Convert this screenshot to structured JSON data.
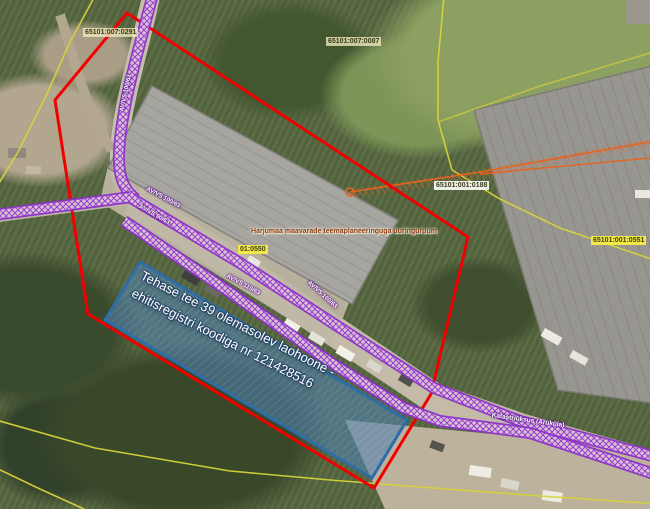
{
  "view": {
    "title": "aerial-planning-map",
    "parcel_labels": [
      {
        "text": "65101:007:0291"
      },
      {
        "text": "65101:007:0087"
      },
      {
        "text": "65101:001:0188"
      },
      {
        "text": "65101:001:0551"
      },
      {
        "text": "01:0550"
      }
    ],
    "survey_area_label": {
      "text": "Harjumaa maavarade teemaplaneeringuga uuringuruum"
    },
    "utility_labels": [
      {
        "text": "AV/VS 100/63"
      },
      {
        "text": "AV/VS 100/63"
      },
      {
        "text": "AV/VS 90/63"
      },
      {
        "text": "AV/VS 110/63"
      },
      {
        "text": "AV/VS 100/63"
      },
      {
        "text": "Katastriüksus (Aruküla)"
      }
    ],
    "highlighted_building_label": {
      "line1": "Tehase tee 39 olemasolev laohoone -",
      "line2": "ehitisregistri koodiga nr 121428516",
      "full_text": "Tehase tee 39 olemasolev laohoone - ehitisregistri koodiga nr 121428516"
    },
    "legend_colors": {
      "planning_boundary": "#ff0000",
      "utility_line": "#8b2fc9",
      "cadastral_line": "#d6d33a",
      "survey_line": "#e8631f",
      "highlight_fill": "#4a7dad",
      "highlight_border": "#2f6da8",
      "parcel_label_highlight_bg": "#f2e84a"
    }
  }
}
